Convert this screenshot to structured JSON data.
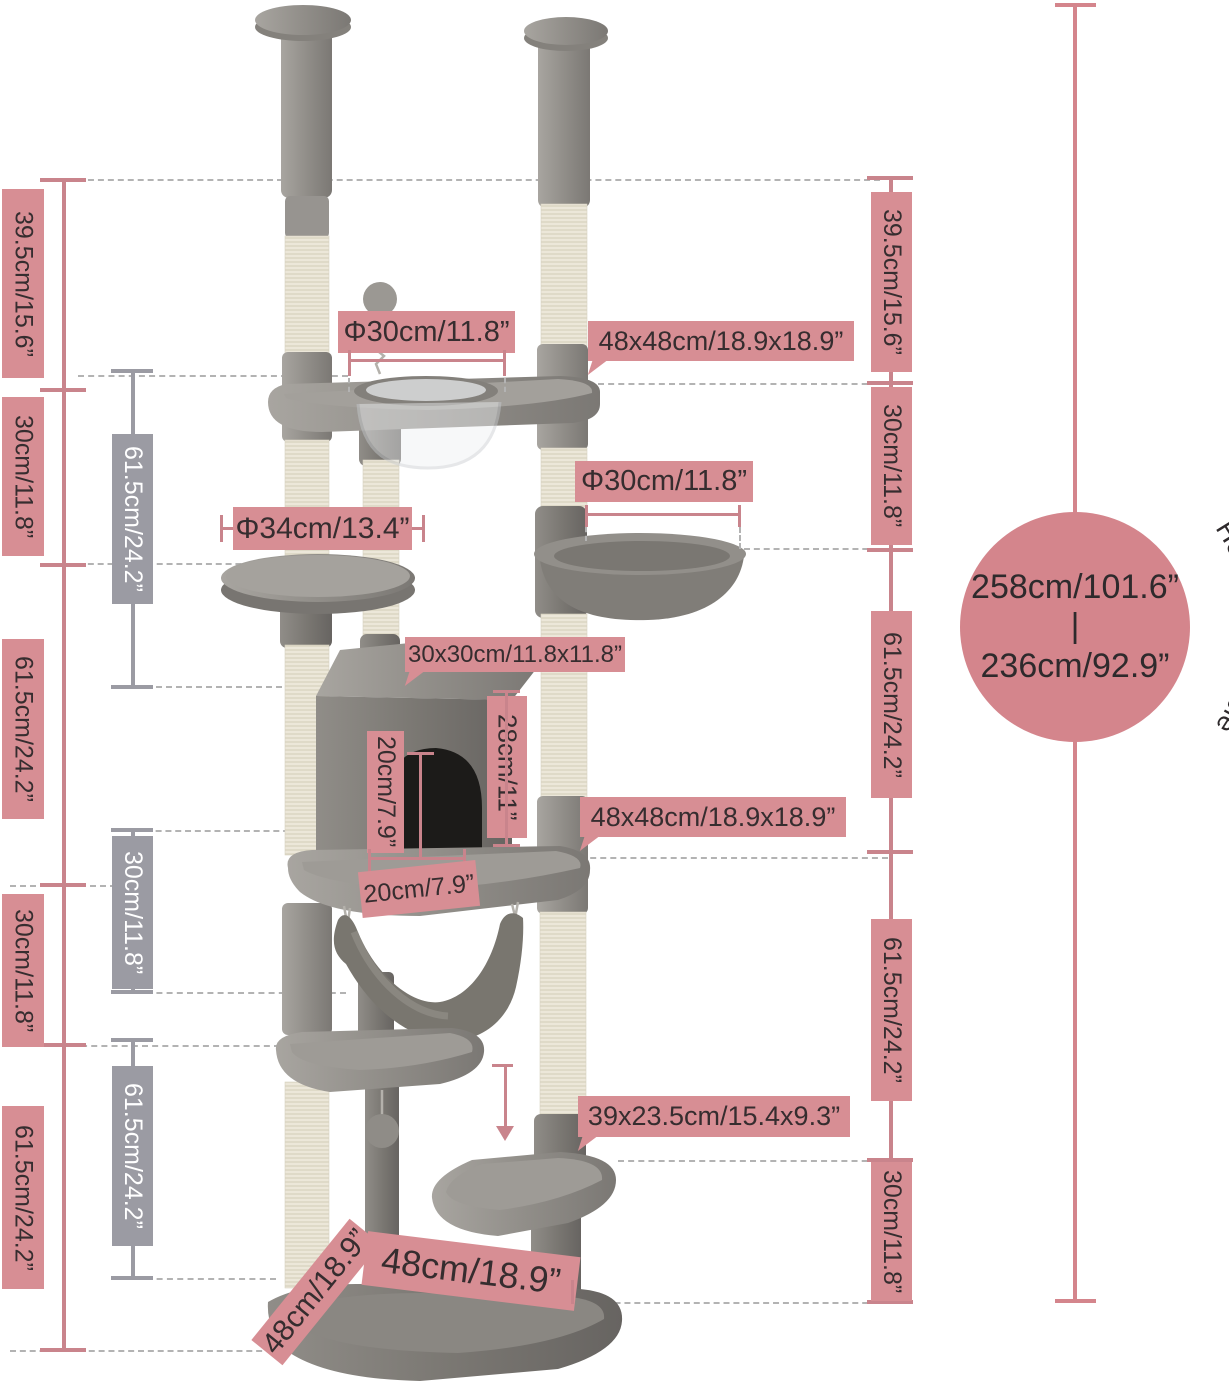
{
  "colors": {
    "pink": "#d78e94",
    "pink_line": "#c9848c",
    "gray_label": "#9b9ba3",
    "text_dark": "#362d2f",
    "dash": "#b3b3b3",
    "circle": "#d4858c"
  },
  "left_column": [
    "39.5cm/15.6”",
    "30cm/11.8”",
    "61.5cm/24.2”",
    "30cm/11.8”",
    "61.5cm/24.2”"
  ],
  "right_column": [
    "39.5cm/15.6”",
    "30cm/11.8”",
    "61.5cm/24.2”",
    "61.5cm/24.2”",
    "30cm/11.8”"
  ],
  "gray_column": [
    "61.5cm/24.2”",
    "30cm/11.8”",
    "61.5cm/24.2”"
  ],
  "callouts": {
    "top_platform_diameter": "Φ30cm/11.8”",
    "top_platform_size": "48x48cm/18.9x18.9”",
    "round_perch_diameter": "Φ34cm/13.4”",
    "basket_diameter": "Φ30cm/11.8”",
    "condo_size": "30x30cm/11.8x11.8”",
    "condo_height": "28cm/11”",
    "door_height": "20cm/7.9”",
    "door_width": "20cm/7.9”",
    "lower_platform_size": "48x48cm/18.9x18.9”",
    "step_size": "39x23.5cm/15.4x9.3”",
    "base_width": "48cm/18.9”",
    "base_depth": "48cm/18.9”"
  },
  "height_range": {
    "max": "258cm/101.6”",
    "divider": "|",
    "min": "236cm/92.9”",
    "note": "Height Adjustable"
  }
}
